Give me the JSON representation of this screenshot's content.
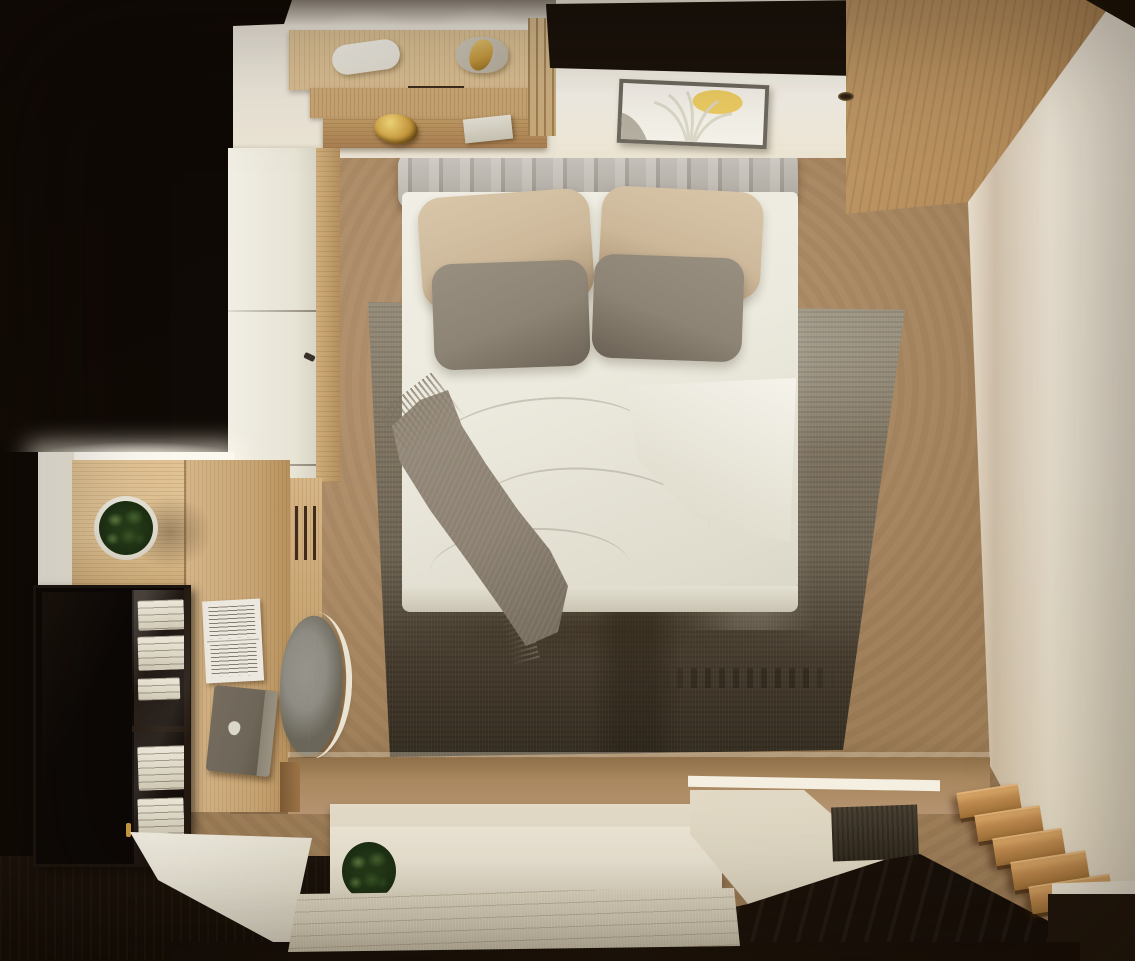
{
  "scene": {
    "title": "Overhead 3D render of a compact modern bedroom",
    "view": "top-down",
    "style": "photorealistic interior visualization"
  },
  "palette": {
    "black": "#120b06",
    "wallCream": "#efe7d6",
    "wallBright": "#f7f3ea",
    "woodLight": "#dcc093",
    "woodMid": "#c8a471",
    "woodDeep": "#a97f52",
    "floorTan": "#b3916f",
    "rugLight": "#978d7b",
    "rugMid": "#6e6453",
    "rugDark": "#463c2e",
    "headboardGray": "#b8b3aa",
    "pillowBeige": "#cdb89a",
    "pillowGray": "#8d8475",
    "duvetWhite": "#eceade",
    "throwTaupe": "#8b8071",
    "benchCream": "#ece5d4",
    "matBeige": "#d9d0ba",
    "stairWood": "#c08b50",
    "glossBrown": "#1f150c",
    "artYellow": "#eecb57",
    "goldAccent": "#c99a3f",
    "plantGreen": "#46632f",
    "chairGray": "#8f8c84",
    "laptopGray": "#6e6659",
    "paperWhite": "#ece8df"
  },
  "objects": {
    "bed": {
      "label": "double bed with white duvet"
    },
    "headboard": {
      "label": "channel-tufted light-gray headboard"
    },
    "pillows": {
      "back_pair": "beige",
      "front_pair": "gray"
    },
    "throw_blanket": {
      "label": "taupe fringed throw draped across left side of bed"
    },
    "rug": {
      "label": "distressed vintage rug, light at top fading to dark brown, faint worn lettering"
    },
    "wall_art": {
      "label": "framed abstract print with yellow sun, pale leaf fan and gray corner shape"
    },
    "vanity_shelves": {
      "label": "stacked oak shelves with lit lamp, figurine, gold bowl and white book"
    },
    "wardrobe_left": {
      "label": "white wardrobe with seams and dark handles"
    },
    "wardrobe_right": {
      "label": "angled wood wardrobe panel with recessed spotlight"
    },
    "desk": {
      "label": "L-shaped oak desk with potted plant, paper document and closed laptop"
    },
    "desk_chair": {
      "label": "gray shell chair with cream back frame"
    },
    "display_cabinet": {
      "label": "black display cabinet, glass side showing white books"
    },
    "bench_platform": {
      "label": "cream platform bench at foot of room with small plant"
    },
    "woven_mat": {
      "label": "beige woven runner mat"
    },
    "staircase": {
      "label": "wood steps descending at lower right"
    },
    "glass_balustrade": {
      "label": "dark glossy panel reflecting the rug"
    }
  }
}
